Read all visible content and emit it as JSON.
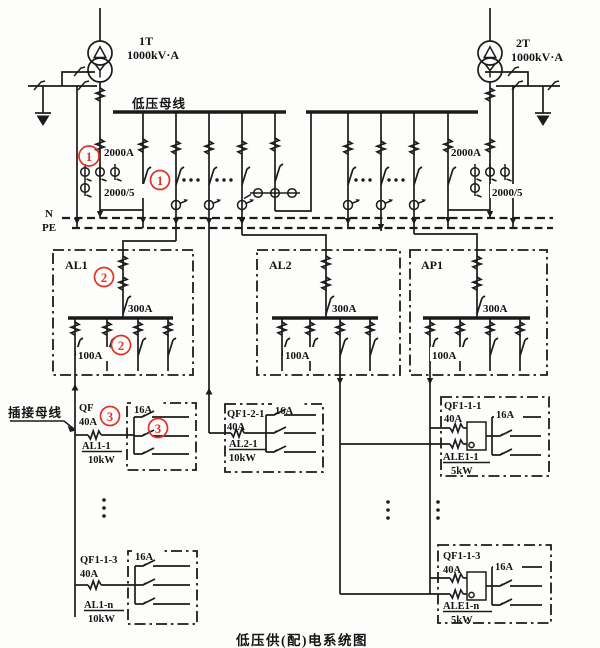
{
  "title": "低压供(配)电系统图",
  "colors": {
    "ink": "#1b1b1b",
    "annotation_red": "#e03226",
    "background": "#fdfdfb"
  },
  "transformers": {
    "t1": {
      "id": "1T",
      "rating": "1000kV·A"
    },
    "t2": {
      "id": "2T",
      "rating": "1000kV·A"
    }
  },
  "bus": {
    "label": "低压母线",
    "incomer_amps": "2000A",
    "ct_ratio": "2000/5"
  },
  "mains": {
    "n": "N",
    "pe": "PE"
  },
  "plug_bus": {
    "label": "插接母线"
  },
  "panels": {
    "al1": {
      "name": "AL1",
      "main": "300A",
      "feeder": "100A"
    },
    "al2": {
      "name": "AL2",
      "main": "300A",
      "feeder": "100A"
    },
    "ap1": {
      "name": "AP1",
      "main": "300A",
      "feeder": "100A"
    }
  },
  "floors": {
    "f1": {
      "qf": "QF",
      "amps": "40A",
      "panel": "AL1-1",
      "load": "10kW",
      "branch": "16A"
    },
    "f2": {
      "qf": "QF1-2-1",
      "amps": "40A",
      "panel": "AL2-1",
      "load": "10kW",
      "branch": "16A"
    },
    "f3": {
      "qf": "QF1-1-1",
      "amps": "40A",
      "panel": "ALE1-1",
      "load": "5kW",
      "branch": "16A"
    },
    "f4": {
      "qf": "QF1-1-3",
      "amps": "40A",
      "panel": "AL1-n",
      "load": "10kW",
      "branch": "16A"
    },
    "f5": {
      "qf": "QF1-1-3",
      "amps": "40A",
      "panel": "ALE1-n",
      "load": "5kW",
      "branch": "16A"
    }
  },
  "annotations": {
    "a1": "1",
    "a2": "2",
    "a3": "3"
  }
}
